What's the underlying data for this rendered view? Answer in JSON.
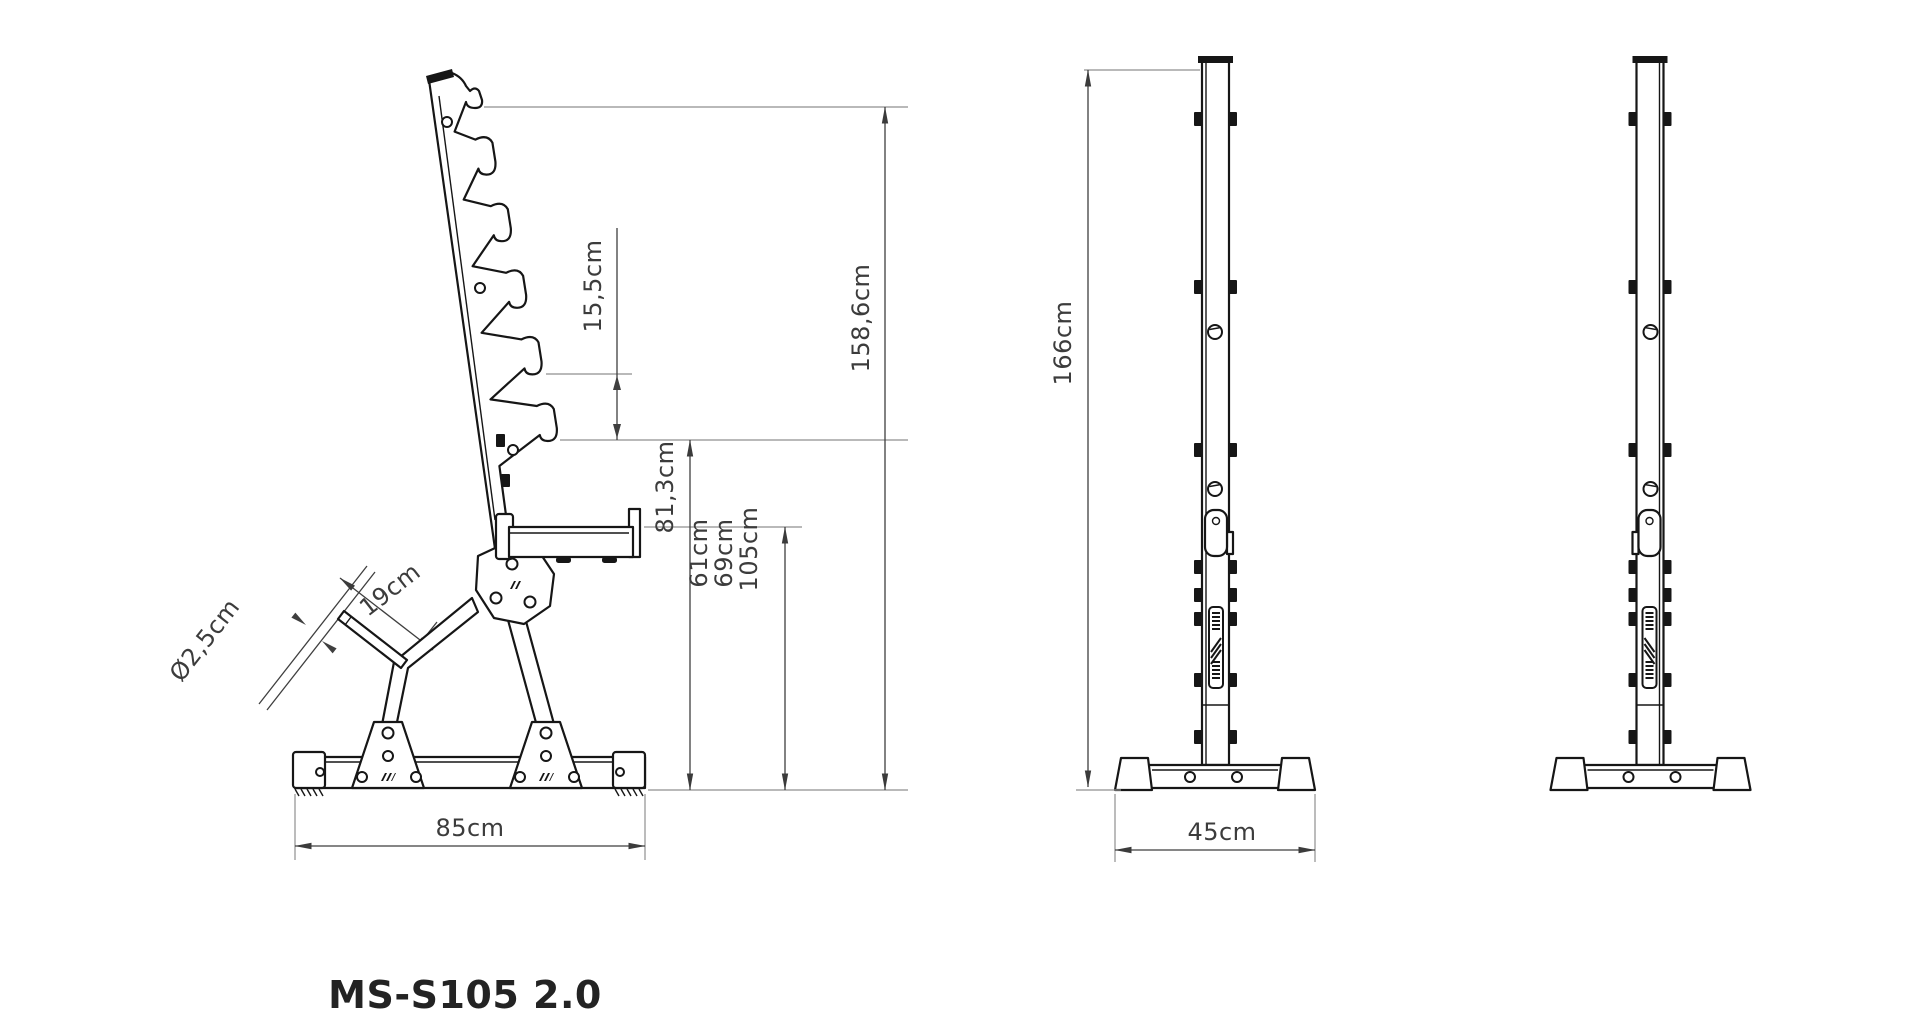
{
  "title": "MS-S105 2.0",
  "dimensions": {
    "hook_spacing": "15,5cm",
    "rack_height": "158,6cm",
    "lowest_hook_height": "81,3cm",
    "shelf_height_1": "61cm",
    "shelf_height_2": "69cm",
    "shelf_height_3": "105cm",
    "base_length": "85cm",
    "peg_length": "19cm",
    "peg_diameter": "Ø2,5cm",
    "upright_height": "166cm",
    "base_width": "45cm"
  },
  "colors": {
    "outline": "#161616",
    "dimension": "#3f3f3f",
    "extension": "#8f8f8f",
    "label": "#3c3c3c",
    "background": "#ffffff"
  }
}
